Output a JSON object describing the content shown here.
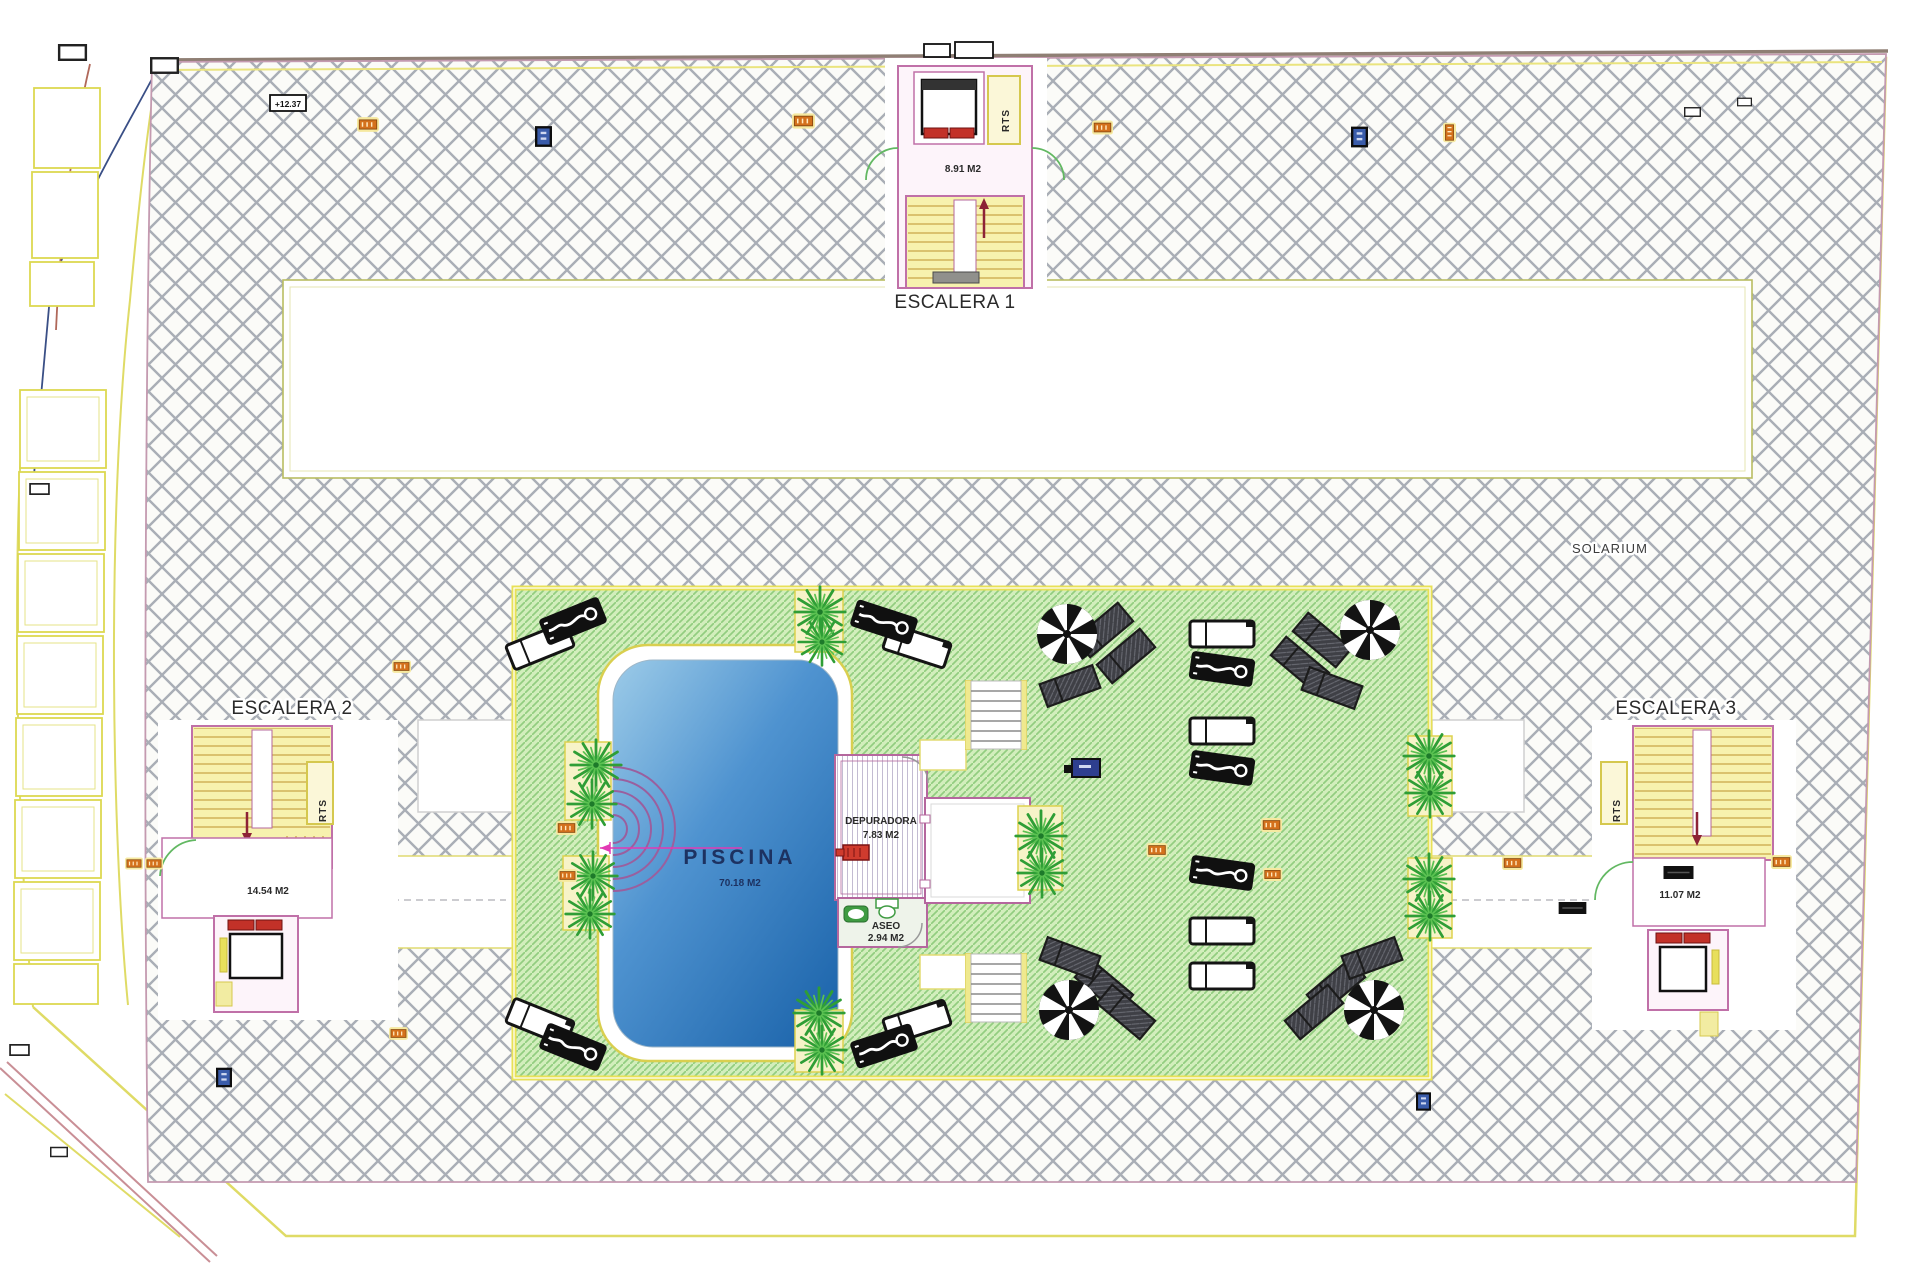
{
  "drawing": {
    "stairs": {
      "escalera1": {
        "label": "ESCALERA 1",
        "area": "8.91 M2"
      },
      "escalera2": {
        "label": "ESCALERA 2",
        "area": "14.54 M2"
      },
      "escalera3": {
        "label": "ESCALERA 3",
        "area": "11.07 M2"
      },
      "riser_room": "RTS"
    },
    "areas": {
      "solarium": "SOLARIUM",
      "piscina": {
        "label": "PISCINA",
        "area": "70.18 M2"
      },
      "depuradora": {
        "label": "DEPURADORA",
        "area": "7.83 M2"
      },
      "aseo": {
        "label": "ASEO",
        "area": "2.94 M2"
      }
    },
    "annotations": {
      "elevation": "+12.37"
    },
    "colors": {
      "hatch_line": "#a9aeb6",
      "deck_border": "#c49ab0",
      "boundary_yellow": "#dfdb66",
      "green_deck": "#d2eebc",
      "green_hatch": "#92cd80",
      "pool_light": "#9ccbe8",
      "pool_deep": "#1f67ad",
      "stair_fill": "#f7f2ae",
      "wall_pink": "#c070a8",
      "door_green": "#62b862",
      "accent_red": "#c23128",
      "marker_orange": "#d4711c",
      "marker_blue": "#3a5caa"
    }
  }
}
